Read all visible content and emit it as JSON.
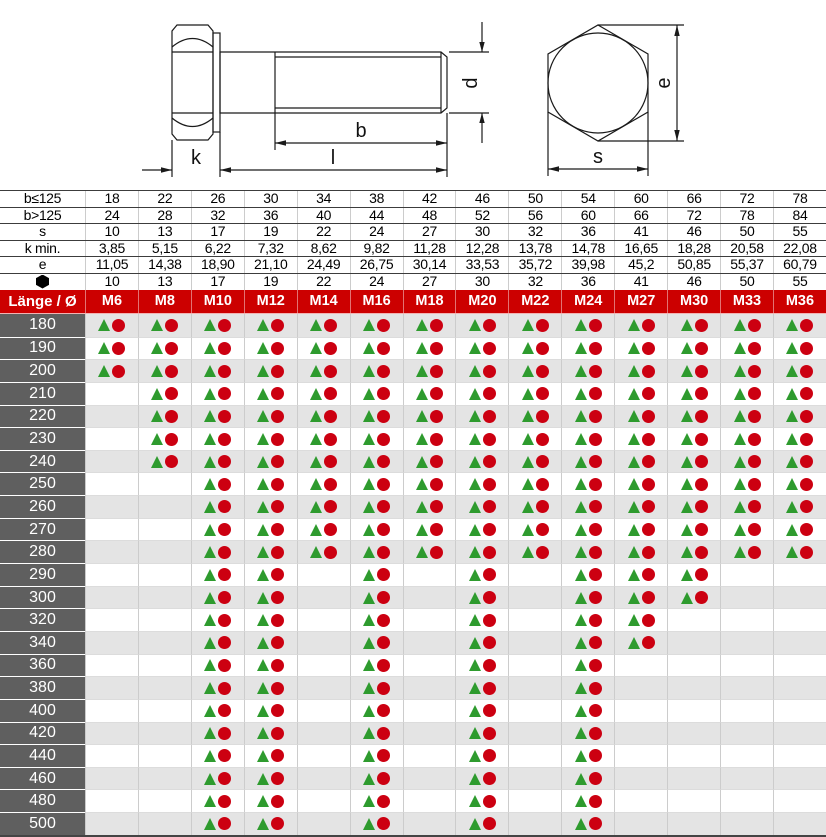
{
  "drawing": {
    "labels": {
      "k": "k",
      "l": "l",
      "b": "b",
      "d": "d",
      "e": "e",
      "s": "s"
    }
  },
  "dim_table": {
    "rows": [
      {
        "label": "b≤125",
        "values": [
          "18",
          "22",
          "26",
          "30",
          "34",
          "38",
          "42",
          "46",
          "50",
          "54",
          "60",
          "66",
          "72",
          "78"
        ]
      },
      {
        "label": "b>125",
        "values": [
          "24",
          "28",
          "32",
          "36",
          "40",
          "44",
          "48",
          "52",
          "56",
          "60",
          "66",
          "72",
          "78",
          "84"
        ]
      },
      {
        "label": "s",
        "values": [
          "10",
          "13",
          "17",
          "19",
          "22",
          "24",
          "27",
          "30",
          "32",
          "36",
          "41",
          "46",
          "50",
          "55"
        ]
      },
      {
        "label": "k min.",
        "values": [
          "3,85",
          "5,15",
          "6,22",
          "7,32",
          "8,62",
          "9,82",
          "11,28",
          "12,28",
          "13,78",
          "14,78",
          "16,65",
          "18,28",
          "20,58",
          "22,08"
        ]
      },
      {
        "label": "e",
        "values": [
          "11,05",
          "14,38",
          "18,90",
          "21,10",
          "24,49",
          "26,75",
          "30,14",
          "33,53",
          "35,72",
          "39,98",
          "45,2",
          "50,85",
          "55,37",
          "60,79"
        ]
      },
      {
        "label": "",
        "icon": "hexagon",
        "values": [
          "10",
          "13",
          "17",
          "19",
          "22",
          "24",
          "27",
          "30",
          "32",
          "36",
          "41",
          "46",
          "50",
          "55"
        ]
      }
    ]
  },
  "matrix": {
    "corner_label": "Länge / Ø",
    "columns": [
      "M6",
      "M8",
      "M10",
      "M12",
      "M14",
      "M16",
      "M18",
      "M20",
      "M22",
      "M24",
      "M27",
      "M30",
      "M33",
      "M36"
    ],
    "rows": [
      {
        "length": "180",
        "available": [
          1,
          1,
          1,
          1,
          1,
          1,
          1,
          1,
          1,
          1,
          1,
          1,
          1,
          1
        ]
      },
      {
        "length": "190",
        "available": [
          1,
          1,
          1,
          1,
          1,
          1,
          1,
          1,
          1,
          1,
          1,
          1,
          1,
          1
        ]
      },
      {
        "length": "200",
        "available": [
          1,
          1,
          1,
          1,
          1,
          1,
          1,
          1,
          1,
          1,
          1,
          1,
          1,
          1
        ]
      },
      {
        "length": "210",
        "available": [
          0,
          1,
          1,
          1,
          1,
          1,
          1,
          1,
          1,
          1,
          1,
          1,
          1,
          1
        ]
      },
      {
        "length": "220",
        "available": [
          0,
          1,
          1,
          1,
          1,
          1,
          1,
          1,
          1,
          1,
          1,
          1,
          1,
          1
        ]
      },
      {
        "length": "230",
        "available": [
          0,
          1,
          1,
          1,
          1,
          1,
          1,
          1,
          1,
          1,
          1,
          1,
          1,
          1
        ]
      },
      {
        "length": "240",
        "available": [
          0,
          1,
          1,
          1,
          1,
          1,
          1,
          1,
          1,
          1,
          1,
          1,
          1,
          1
        ]
      },
      {
        "length": "250",
        "available": [
          0,
          0,
          1,
          1,
          1,
          1,
          1,
          1,
          1,
          1,
          1,
          1,
          1,
          1
        ]
      },
      {
        "length": "260",
        "available": [
          0,
          0,
          1,
          1,
          1,
          1,
          1,
          1,
          1,
          1,
          1,
          1,
          1,
          1
        ]
      },
      {
        "length": "270",
        "available": [
          0,
          0,
          1,
          1,
          1,
          1,
          1,
          1,
          1,
          1,
          1,
          1,
          1,
          1
        ]
      },
      {
        "length": "280",
        "available": [
          0,
          0,
          1,
          1,
          1,
          1,
          1,
          1,
          1,
          1,
          1,
          1,
          1,
          1
        ]
      },
      {
        "length": "290",
        "available": [
          0,
          0,
          1,
          1,
          0,
          1,
          0,
          1,
          0,
          1,
          1,
          1,
          0,
          0
        ]
      },
      {
        "length": "300",
        "available": [
          0,
          0,
          1,
          1,
          0,
          1,
          0,
          1,
          0,
          1,
          1,
          1,
          0,
          0
        ]
      },
      {
        "length": "320",
        "available": [
          0,
          0,
          1,
          1,
          0,
          1,
          0,
          1,
          0,
          1,
          1,
          0,
          0,
          0
        ]
      },
      {
        "length": "340",
        "available": [
          0,
          0,
          1,
          1,
          0,
          1,
          0,
          1,
          0,
          1,
          1,
          0,
          0,
          0
        ]
      },
      {
        "length": "360",
        "available": [
          0,
          0,
          1,
          1,
          0,
          1,
          0,
          1,
          0,
          1,
          0,
          0,
          0,
          0
        ]
      },
      {
        "length": "380",
        "available": [
          0,
          0,
          1,
          1,
          0,
          1,
          0,
          1,
          0,
          1,
          0,
          0,
          0,
          0
        ]
      },
      {
        "length": "400",
        "available": [
          0,
          0,
          1,
          1,
          0,
          1,
          0,
          1,
          0,
          1,
          0,
          0,
          0,
          0
        ]
      },
      {
        "length": "420",
        "available": [
          0,
          0,
          1,
          1,
          0,
          1,
          0,
          1,
          0,
          1,
          0,
          0,
          0,
          0
        ]
      },
      {
        "length": "440",
        "available": [
          0,
          0,
          1,
          1,
          0,
          1,
          0,
          1,
          0,
          1,
          0,
          0,
          0,
          0
        ]
      },
      {
        "length": "460",
        "available": [
          0,
          0,
          1,
          1,
          0,
          1,
          0,
          1,
          0,
          1,
          0,
          0,
          0,
          0
        ]
      },
      {
        "length": "480",
        "available": [
          0,
          0,
          1,
          1,
          0,
          1,
          0,
          1,
          0,
          1,
          0,
          0,
          0,
          0
        ]
      },
      {
        "length": "500",
        "available": [
          0,
          0,
          1,
          1,
          0,
          1,
          0,
          1,
          0,
          1,
          0,
          0,
          0,
          0
        ]
      }
    ]
  },
  "colors": {
    "header_red": "#CC0000",
    "circle_red": "#CC0011",
    "triangle_green": "#2E9B2E",
    "label_gray": "#5F5F5F",
    "row_alt": "#E4E4E4",
    "grid": "#CCCCCC"
  }
}
